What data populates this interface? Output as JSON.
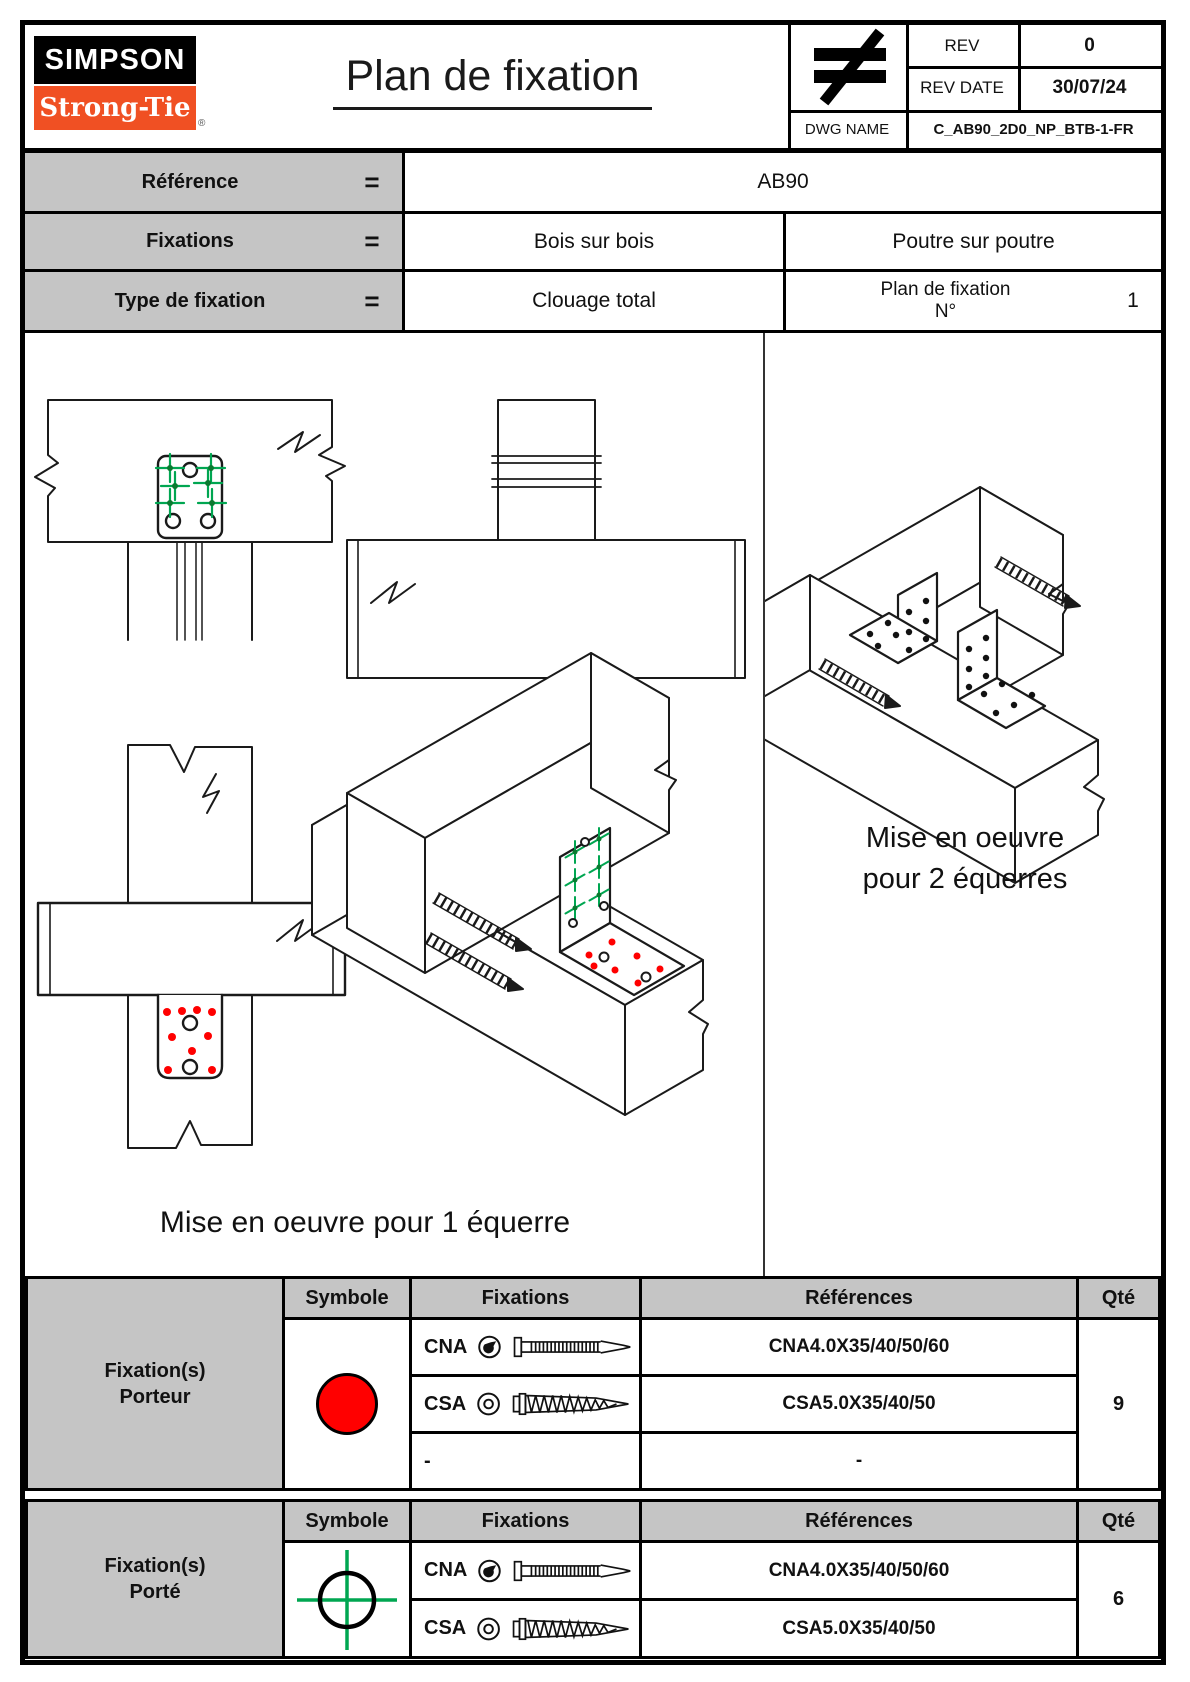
{
  "page": {
    "title": "Plan de fixation"
  },
  "logo": {
    "top": "SIMPSON",
    "bottom": "Strong-Tie",
    "registered": "®"
  },
  "title_block": {
    "neq_symbol": "≠",
    "rev_label": "REV",
    "rev_value": "0",
    "rev_date_label": "REV DATE",
    "rev_date_value": "30/07/24",
    "dwg_name_label": "DWG NAME",
    "dwg_name_value": "C_AB90_2D0_NP_BTB-1-FR"
  },
  "info_table": {
    "rows": [
      {
        "label": "Référence",
        "eq": "=",
        "value": "AB90"
      },
      {
        "label": "Fixations",
        "eq": "=",
        "value_left": "Bois sur bois",
        "value_right": "Poutre sur poutre"
      },
      {
        "label": "Type de fixation",
        "eq": "=",
        "value_left": "Clouage total",
        "plan_label_line1": "Plan de fixation",
        "plan_label_line2": "N°",
        "plan_number": "1"
      }
    ]
  },
  "drawings": {
    "caption_single": "Mise en oeuvre pour 1 équerre",
    "caption_double_line1": "Mise en oeuvre",
    "caption_double_line2": "pour 2 équerres",
    "marker_legend": {
      "green_crosshair": "fixation porté",
      "red_dot": "fixation porteur"
    }
  },
  "fixation_tables": [
    {
      "group_line1": "Fixation(s)",
      "group_line2": "Porteur",
      "symbol": "red-filled-circle",
      "headers": {
        "symbole": "Symbole",
        "fixations": "Fixations",
        "references": "Références",
        "qty": "Qté"
      },
      "rows": [
        {
          "code": "CNA",
          "reference": "CNA4.0X35/40/50/60"
        },
        {
          "code": "CSA",
          "reference": "CSA5.0X35/40/50"
        },
        {
          "code": "-",
          "reference": "-"
        }
      ],
      "qty": "9"
    },
    {
      "group_line1": "Fixation(s)",
      "group_line2": "Porté",
      "symbol": "black-circle-green-crosshair",
      "headers": {
        "symbole": "Symbole",
        "fixations": "Fixations",
        "references": "Références",
        "qty": "Qté"
      },
      "rows": [
        {
          "code": "CNA",
          "reference": "CNA4.0X35/40/50/60"
        },
        {
          "code": "CSA",
          "reference": "CSA5.0X35/40/50"
        }
      ],
      "qty": "6"
    }
  ],
  "colors": {
    "logo_orange": "#f05023",
    "marker_red": "#ff0000",
    "marker_green": "#00a651",
    "header_gray": "#c5c5c5"
  }
}
